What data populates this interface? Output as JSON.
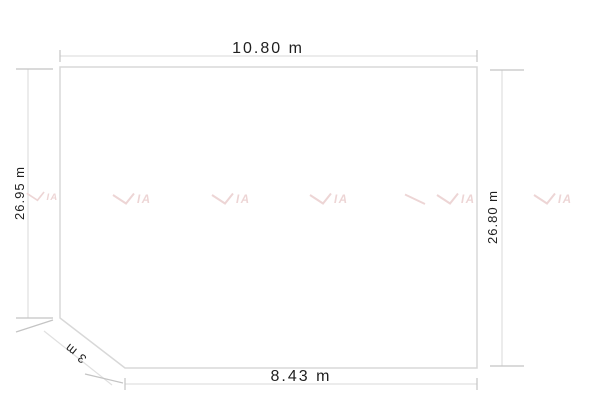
{
  "colors": {
    "background": "#ffffff",
    "outline": "#d8d8d8",
    "dim_line": "#e0e0e0",
    "tick": "#c4c4c4",
    "text": "#1f1f1f",
    "watermark": "#edd5d5"
  },
  "dimensions": {
    "top": {
      "label": "10.80 m"
    },
    "left": {
      "label": "26.95 m"
    },
    "right": {
      "label": "26.80 m"
    },
    "bottom": {
      "label": "8.43 m"
    },
    "chamfer": {
      "label": "3 m"
    }
  },
  "watermark": {
    "letters": "IA"
  }
}
